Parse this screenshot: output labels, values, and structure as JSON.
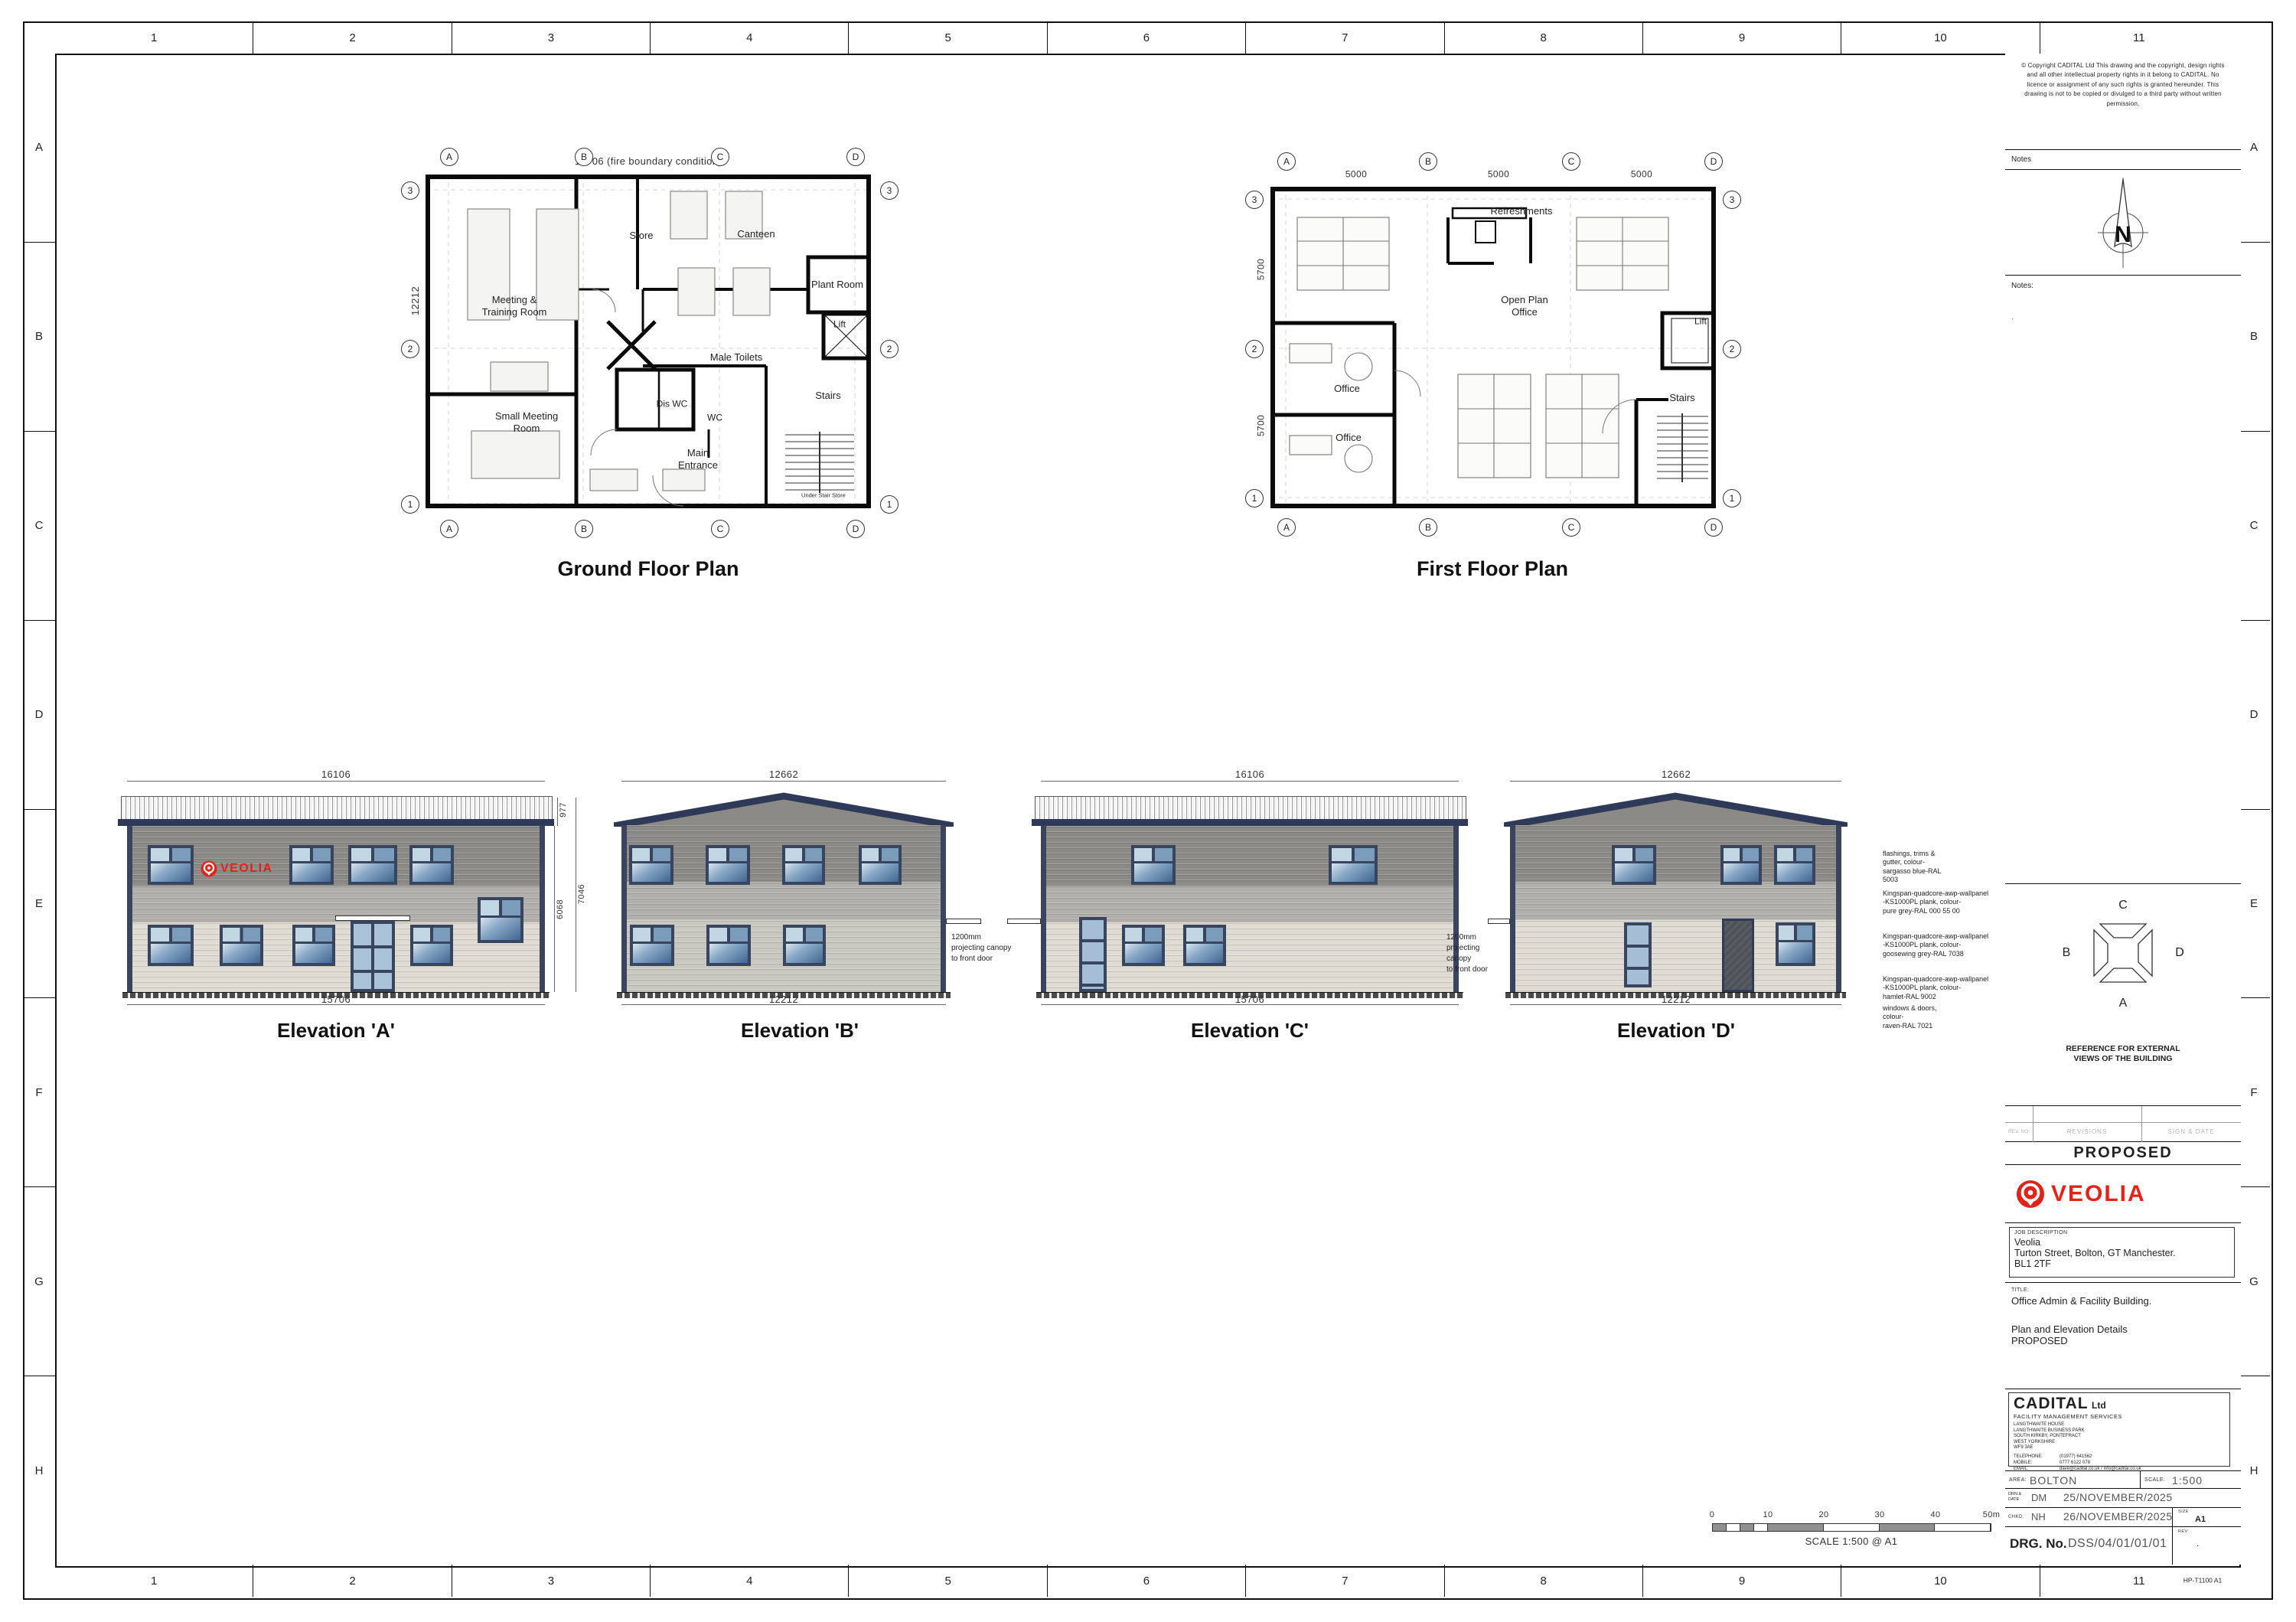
{
  "sheet": {
    "grid_columns": [
      "1",
      "2",
      "3",
      "4",
      "5",
      "6",
      "7",
      "8",
      "9",
      "10",
      "11"
    ],
    "grid_rows": [
      "A",
      "B",
      "C",
      "D",
      "E",
      "F",
      "G",
      "H"
    ],
    "paper_ref": "HP-T1100 A1"
  },
  "title_block": {
    "copyright": "©  Copyright CADITAL Ltd This drawing and the copyright, design rights and all other intellectual property rights in it belong to CADITAL. No licence or assignment of any such rights is granted hereunder. This drawing is not to be copied or divulged to a third party without written permission.",
    "notes_label": "Notes",
    "notes2_label": "Notes:",
    "notes2_content": ".",
    "north_letter": "N",
    "compass": {
      "top": "C",
      "left": "B",
      "right": "D",
      "bottom": "A",
      "caption": "REFERENCE FOR EXTERNAL\nVIEWS OF THE BUILDING"
    },
    "revision_header": {
      "rev_no": "REV. NO.",
      "revisions": "REVISIONS",
      "sign_date": "SIGN & DATE"
    },
    "status": "PROPOSED",
    "logo_text": "VEOLIA",
    "job": {
      "label": "JOB DESCRIPTION",
      "line1": "Veolia",
      "line2": "Turton Street, Bolton, GT Manchester.",
      "line3": "BL1 2TF"
    },
    "title": {
      "label": "TITLE:",
      "line1": "Office Admin & Facility Building.",
      "line2": "Plan and Elevation Details",
      "line3": "PROPOSED"
    },
    "company": {
      "name": "CADITAL",
      "suffix": "Ltd",
      "tagline": "FACILITY MANAGEMENT SERVICES",
      "address": "LANGTHWAITE HOUSE\nLANGTHWAITE BUSINESS PARK\nSOUTH KIRKBY, PONTEFRACT\nWEST YORKSHIRE\nWF9 3AE",
      "contacts": [
        {
          "label": "TELEPHONE:",
          "value": "(01977) 641562"
        },
        {
          "label": "MOBILE:",
          "value": "0777 6122 078"
        },
        {
          "label": "EMAIL:",
          "value": "dave@cadital.co.uk / info@cadital.co.uk"
        },
        {
          "label": "WWW:",
          "value": "cadital.co.uk"
        }
      ]
    },
    "area": {
      "label": "AREA:",
      "value": "BOLTON",
      "scale_label": "SCALE:",
      "scale_value": "1:500"
    },
    "drawn": {
      "label": "DRN.&\nDATE",
      "initials": "DM",
      "date": "25/NOVEMBER/2025"
    },
    "checked": {
      "label": "CHKD:",
      "initials": "NH",
      "date": "26/NOVEMBER/2025",
      "size_label": "SIZE",
      "size_value": "A1"
    },
    "drawing_no": {
      "label": "DRG. No.",
      "value": "DSS/04/01/01/01",
      "rev_label": "REV:",
      "rev_value": "."
    }
  },
  "ground_floor": {
    "title": "Ground Floor Plan",
    "dim_top": "15706 (fire boundary condition)",
    "dim_left": "12212",
    "grid_letters": [
      "A",
      "B",
      "C",
      "D"
    ],
    "grid_numbers": [
      "3",
      "2",
      "1"
    ],
    "rooms": [
      "Meeting &\nTraining Room",
      "Store",
      "Canteen",
      "Plant Room",
      "Lift",
      "Male Toilets",
      "Small Meeting\nRoom",
      "Dis WC",
      "WC",
      "Main\nEntrance",
      "Stairs",
      "Under Stair Store"
    ]
  },
  "first_floor": {
    "title": "First Floor Plan",
    "dims_top": [
      "5000",
      "5000",
      "5000"
    ],
    "dims_left": [
      "5700",
      "5700"
    ],
    "grid_letters": [
      "A",
      "B",
      "C",
      "D"
    ],
    "grid_numbers": [
      "3",
      "2",
      "1"
    ],
    "rooms": [
      "Refreshments",
      "Open Plan\nOffice",
      "Office",
      "Office",
      "Lift",
      "Stairs"
    ]
  },
  "elevations": [
    {
      "title": "Elevation 'A'",
      "dim_top": "16106",
      "dim_bottom": "15706",
      "dim_roof": "977",
      "dim_wall": "6068",
      "dim_total": "7046",
      "logo": "VEOLIA"
    },
    {
      "title": "Elevation 'B'",
      "dim_top": "12662",
      "dim_bottom": "12212"
    },
    {
      "title": "Elevation 'C'",
      "dim_top": "16106",
      "dim_bottom": "15706"
    },
    {
      "title": "Elevation 'D'",
      "dim_top": "12662",
      "dim_bottom": "12212"
    }
  ],
  "canopy_note": "1200mm\nprojecting canopy\nto front door",
  "material_notes": [
    "flashings, trims &\ngutter, colour-\nsargasso blue-RAL\n5003",
    "Kingspan-quadcore-awp-wallpanel\n-KS1000PL plank, colour-\npure grey-RAL 000 55 00",
    "Kingspan-quadcore-awp-wallpanel\n-KS1000PL plank, colour-\ngoosewing grey-RAL 7038",
    "Kingspan-quadcore-awp-wallpanel\n-KS1000PL plank, colour-\nhamlet-RAL 9002",
    "windows & doors,\ncolour-\nraven-RAL 7021"
  ],
  "scale_bar": {
    "ticks": [
      "0",
      "10",
      "20",
      "30",
      "40",
      "50m"
    ],
    "caption": "SCALE 1:500 @ A1"
  },
  "colors": {
    "veolia_red": "#e2231a",
    "cladding_dark": "#8b8a86",
    "cladding_mid": "#b1b0aa",
    "cladding_light": "#dedcd2",
    "frame_navy": "#39455f",
    "roof_navy": "#2e3a57"
  }
}
